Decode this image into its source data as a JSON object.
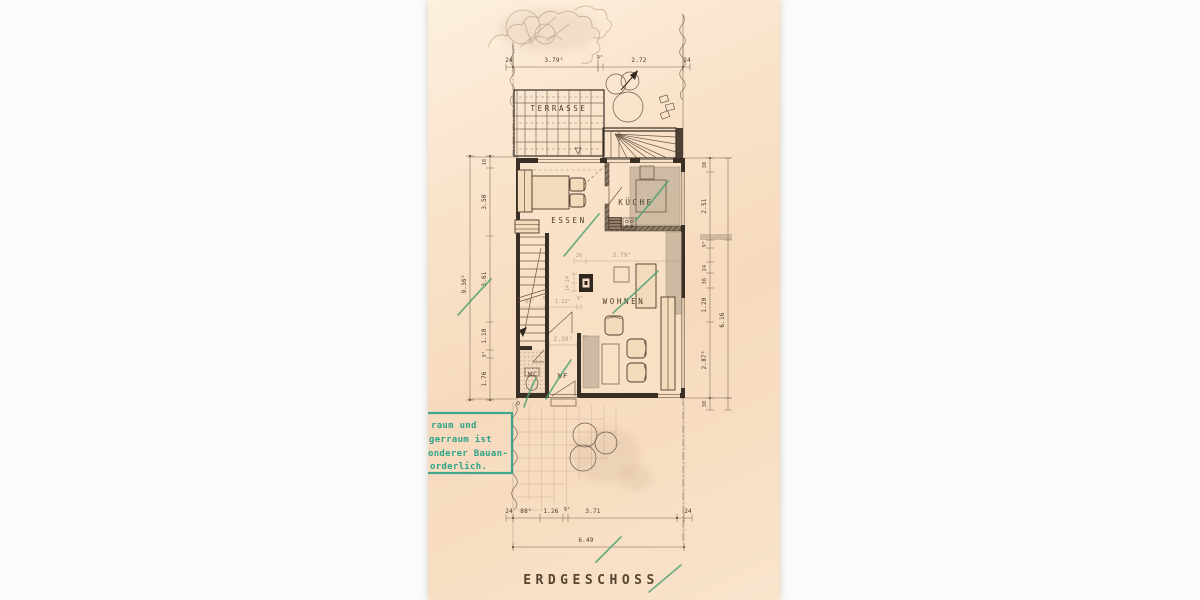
{
  "drawing": {
    "title": "ERDGESCHOSS",
    "rooms": {
      "terrasse": "TERRASSE",
      "essen": "ESSEN",
      "kueche": "KÜCHE",
      "wohnen": "WOHNEN",
      "wf": "WF",
      "wc": "WC"
    },
    "stamp": {
      "line1": "raum und",
      "line2": "gerraum ist",
      "line3": "onderer Bauan-",
      "line4": "orderlich."
    },
    "dims": {
      "top": {
        "a": "24",
        "b": "3.79⁵",
        "c": "9⁵",
        "d": "2.72",
        "e": "24"
      },
      "left": {
        "a": "18",
        "b": "3.50",
        "c": "3.61",
        "d": "1.10",
        "e": "9⁵",
        "f": "1.76",
        "total": "9.36⁵"
      },
      "right": {
        "a": "30",
        "b": "2.51",
        "c": "9⁵",
        "d": "24",
        "e": "36",
        "f": "1.20",
        "g": "2.87⁵",
        "h": "30",
        "total": "6.16"
      },
      "bottom": {
        "a": "24",
        "b": "88⁵",
        "c": "1.26",
        "d": "9⁶",
        "e": "3.71",
        "f": "24",
        "total": "6.49"
      },
      "interior": {
        "chimney_offset": "26",
        "wohnen_width": "3.79⁵",
        "flue_a": "24",
        "flue_b": "14",
        "stair_width": "80⁵",
        "wall_a": "9⁵",
        "hall": "1.22⁵",
        "wall_b": "9⁶",
        "wf_width": "2.20⁵",
        "wall_c": "9⁶"
      }
    },
    "colors": {
      "paper": "#f7dcc3",
      "ink": "#3a2f25",
      "pencil_green": "#4a9f70",
      "stamp_green": "#2ea287"
    }
  }
}
